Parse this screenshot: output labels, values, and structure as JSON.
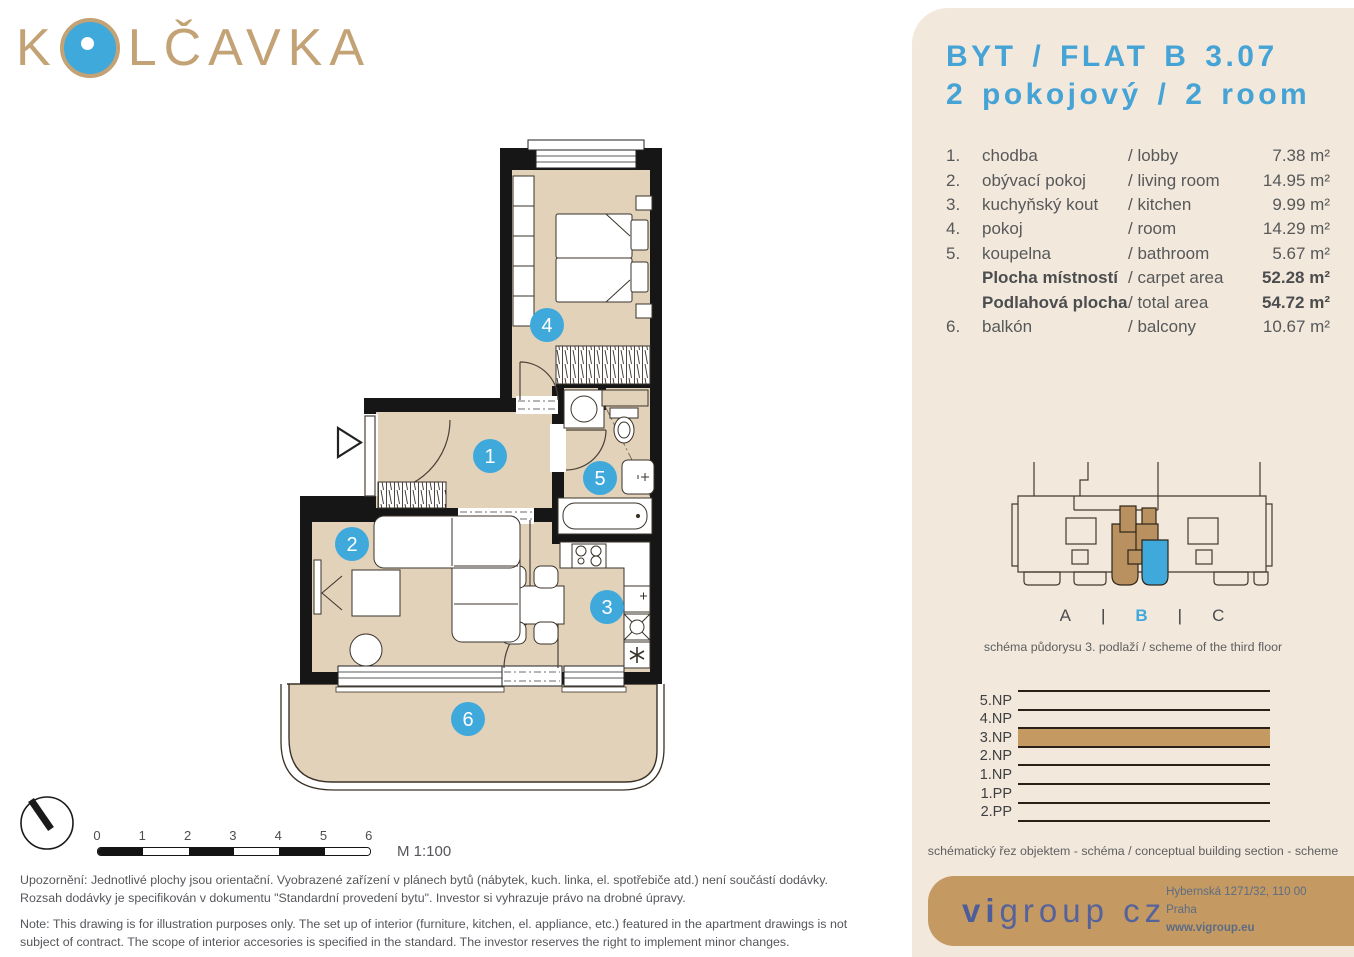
{
  "logo": {
    "pre": "K",
    "post": "LČAVKA",
    "full": "KOLČAVKA"
  },
  "header": {
    "title_line1": "BYT / FLAT B 3.07",
    "title_line2": "2 pokojový / 2 room"
  },
  "rooms": [
    {
      "num": "1.",
      "cz": "chodba",
      "en": "/ lobby",
      "area": "7.38 m²",
      "bold": false
    },
    {
      "num": "2.",
      "cz": "obývací pokoj",
      "en": "/ living room",
      "area": "14.95 m²",
      "bold": false
    },
    {
      "num": "3.",
      "cz": "kuchyňský kout",
      "en": "/ kitchen",
      "area": "9.99 m²",
      "bold": false
    },
    {
      "num": "4.",
      "cz": "pokoj",
      "en": "/ room",
      "area": "14.29 m²",
      "bold": false
    },
    {
      "num": "5.",
      "cz": "koupelna",
      "en": "/ bathroom",
      "area": "5.67 m²",
      "bold": false
    },
    {
      "num": "",
      "cz": "Plocha místností",
      "en": "/ carpet area",
      "area": "52.28 m²",
      "bold": true
    },
    {
      "num": "",
      "cz": "Podlahová plocha",
      "en": "/ total area",
      "area": "54.72 m²",
      "bold": true
    },
    {
      "num": "6.",
      "cz": "balkón",
      "en": "/ balcony",
      "area": "10.67 m²",
      "bold": false
    }
  ],
  "scheme": {
    "sections": [
      "A",
      "B",
      "C"
    ],
    "divider": "|",
    "highlight": "B",
    "caption": "schéma půdorysu 3. podlaží / scheme of the third floor"
  },
  "section_diagram": {
    "floors": [
      "5.NP",
      "4.NP",
      "3.NP",
      "2.NP",
      "1.NP",
      "1.PP",
      "2.PP"
    ],
    "highlighted": "3.NP",
    "caption": "schématický řez objektem - schéma / conceptual building section - scheme"
  },
  "plan": {
    "room_labels": [
      "1",
      "2",
      "3",
      "4",
      "5",
      "6"
    ],
    "scale_label": "M 1:100",
    "scale_ticks": [
      "0",
      "1",
      "2",
      "3",
      "4",
      "5",
      "6"
    ]
  },
  "disclaimer": {
    "cz_label": "Upozornění:",
    "cz_1": " Jednotlivé plochy jsou orientační. Vyobrazené zařízení v plánech bytů (nábytek, kuch. linka, el. spotřebiče atd.) není součástí dodávky.",
    "cz_2": "Rozsah dodávky je specifikován v dokumentu \"Standardní provedení bytu\". Investor si vyhrazuje právo na drobné úpravy.",
    "en_label": "Note:",
    "en_1": " This drawing is for illustration purposes only. The set up of interior (furniture, kitchen, el. appliance, etc.) featured in the apartment drawings is not",
    "en_2": "subject of contract. The scope of interior accesories is specified in the standard. The investor reserves the right to implement minor changes."
  },
  "footer": {
    "logo_vi": "vi",
    "logo_rest": "group cz",
    "address": "Hybernská 1271/32, 110 00 Praha",
    "web": "www.vigroup.eu"
  },
  "colors": {
    "accent_blue": "#3fa9dc",
    "tan": "#c59a62",
    "scheme_brown": "#b9905f",
    "beige_floor": "#e3d2ba",
    "cream": "#f2e9dc",
    "text_gray": "#57585a",
    "wall": "#161616"
  }
}
